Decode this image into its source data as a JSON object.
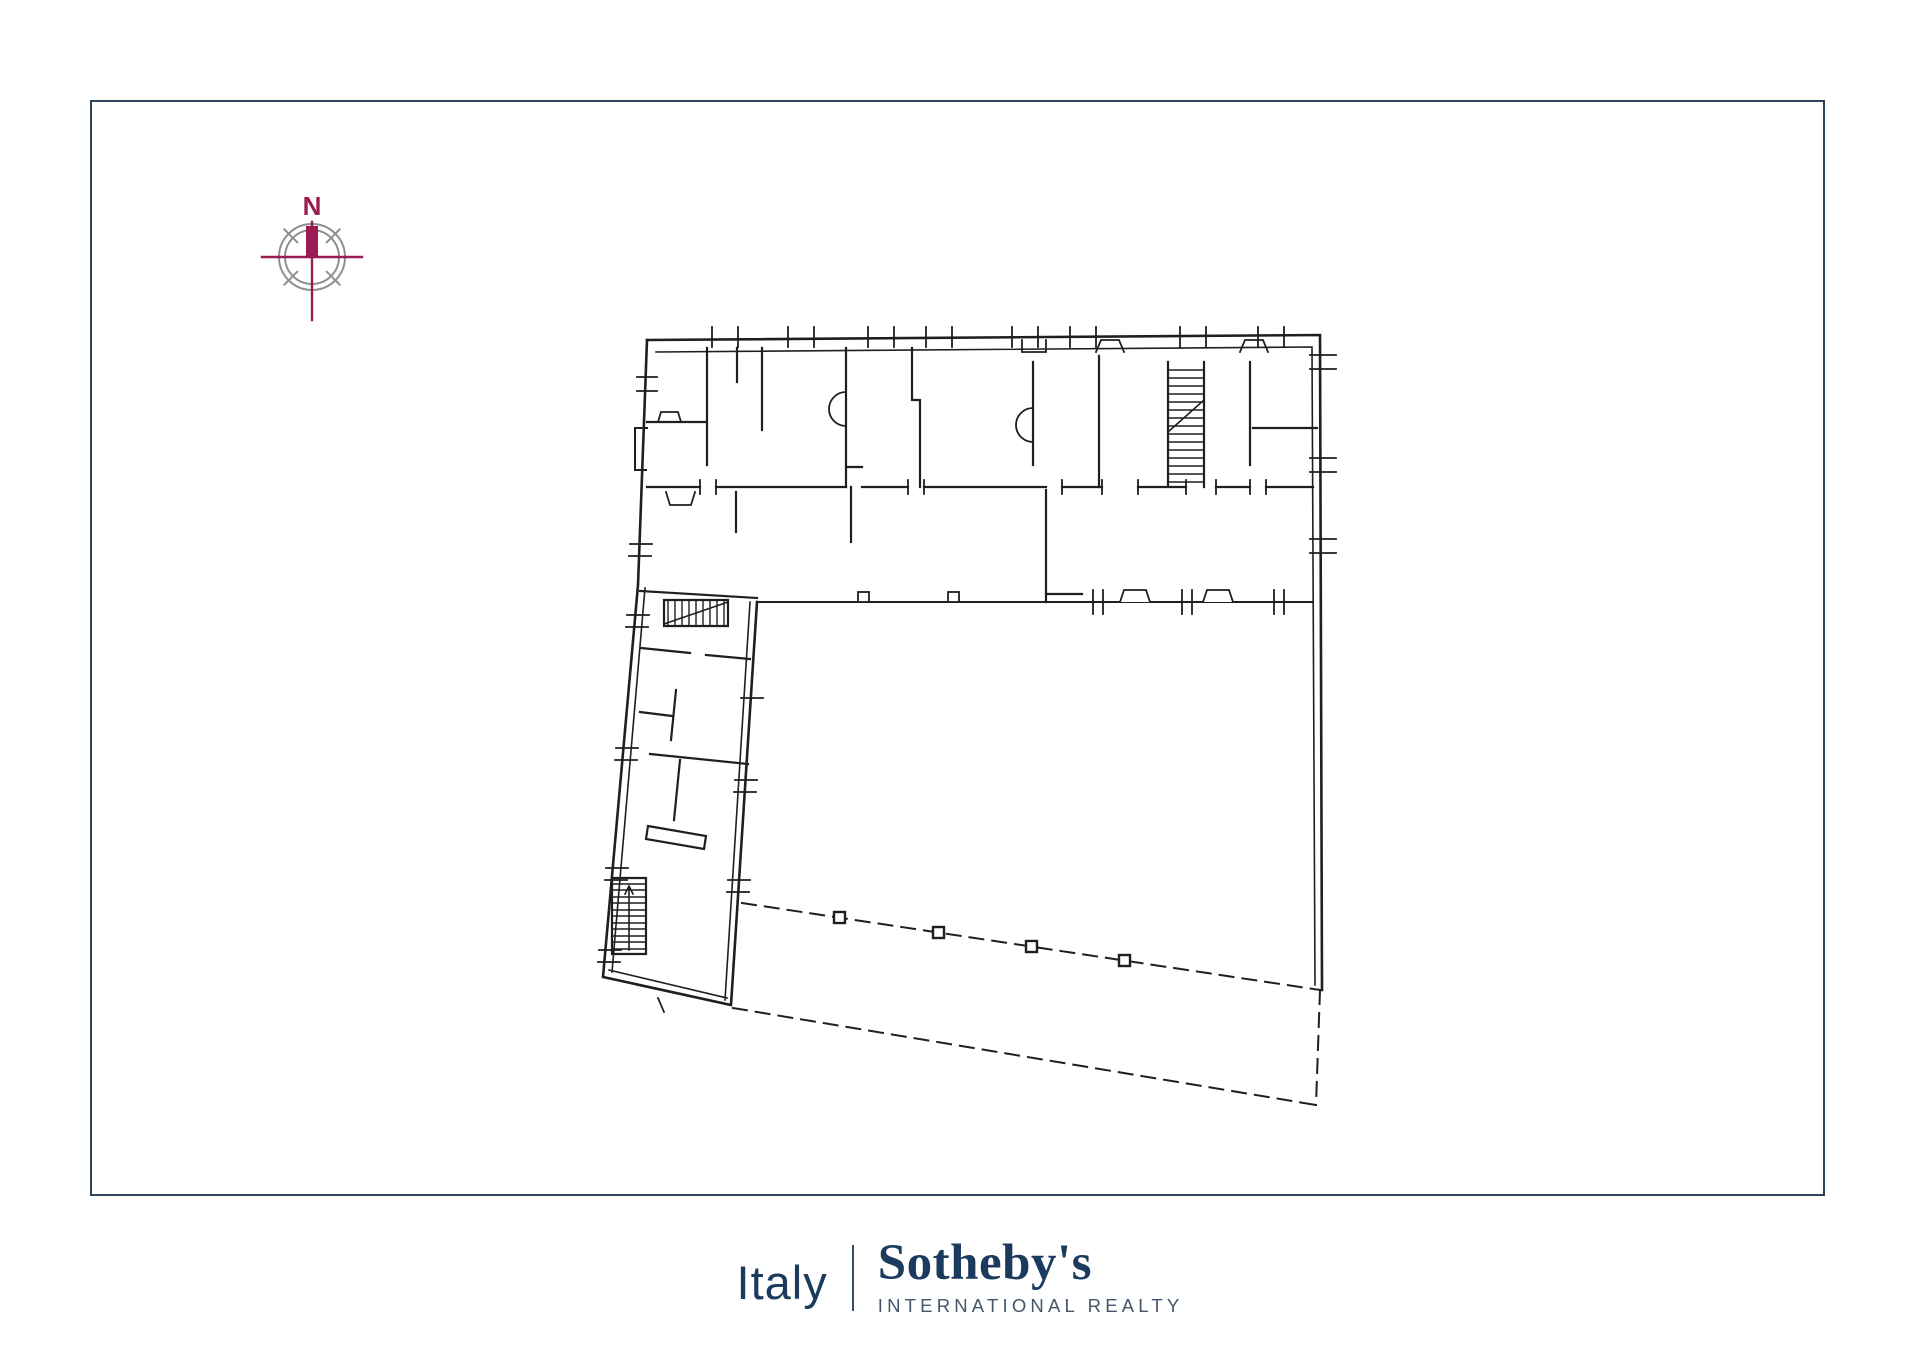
{
  "page": {
    "background_color": "#ffffff",
    "frame_border_color": "#2c4257"
  },
  "compass": {
    "north_label": "N",
    "needle_color": "#9b1b52",
    "ring_color": "#8f8f8f"
  },
  "floor_plan": {
    "line_color": "#1f1f1f",
    "boundary_style": "dashed",
    "boundary_post_count": 4,
    "staircase_count": 3
  },
  "logo": {
    "region_label": "Italy",
    "brand_name": "Sotheby's",
    "subtitle": "INTERNATIONAL REALTY",
    "text_color": "#1c3a5e",
    "subtitle_color": "#44566b"
  }
}
